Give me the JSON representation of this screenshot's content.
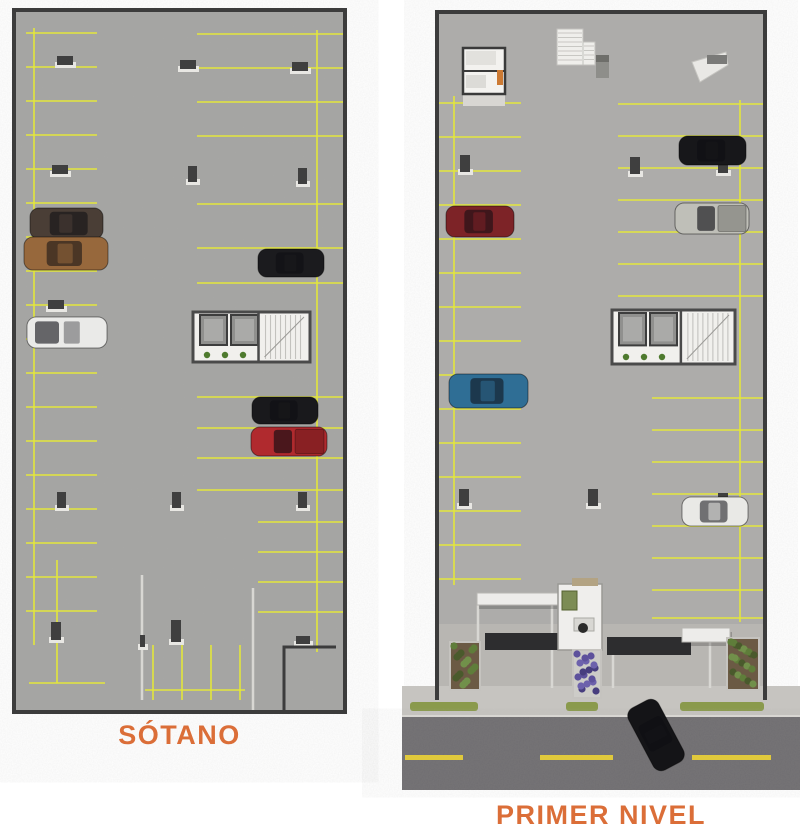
{
  "labels": {
    "sotano": "SÓTANO",
    "primer_nivel": "PRIMER NIVEL"
  },
  "colors": {
    "label_text": "#db6e38",
    "wall": "#3c3c3c",
    "floor_sotano": "#a5a5a3",
    "floor_primer": "#adacaa",
    "plaza": "#b9b7b3",
    "line_yellow": "#e3e63c",
    "line_light": "#d8d7d3",
    "column": "#3f3f3f",
    "column_base": "#e8e7e3",
    "core_floor": "#f1f0ed",
    "core_wall": "#4a4a4a",
    "elevator_cab": "#90908e",
    "plant_green": "#4e7a2e",
    "bush_green": "#5f7d3a",
    "bush_dark": "#4a5a2c",
    "soil_brown": "#6b5a44",
    "flower_purple": "#5d519c",
    "sidewalk": "#c6c4c0",
    "grass_strip": "#8a9a4c",
    "street": "#6f6d70",
    "street_mark": "#e0c93c",
    "drive_dark": "#2d2d2f",
    "canopy_white": "#edecea",
    "booth_wall": "#efeeec",
    "booth_window": "#7c8c54",
    "booth_desk": "#d8d7d3",
    "booth_chair": "#2a2a2a",
    "room_floor": "#f3f2ef",
    "accent_orange": "#cc7a33"
  },
  "plans": [
    {
      "id": "sotano",
      "label_key": "sotano",
      "floor": [
        14,
        10,
        331,
        702
      ],
      "wall": "rect",
      "yellow_vlines": [
        [
          34,
          28,
          645
        ],
        [
          57,
          560,
          683
        ],
        [
          317,
          30,
          652
        ],
        [
          153,
          645,
          700
        ],
        [
          182,
          645,
          700
        ],
        [
          211,
          645,
          700
        ],
        [
          240,
          645,
          700
        ]
      ],
      "yellow_hlines": [
        {
          "x1": 26,
          "x2": 97,
          "ys": [
            33,
            67,
            101,
            135,
            169,
            203,
            237,
            271,
            305,
            339,
            373,
            407,
            441,
            475,
            509,
            543,
            577,
            611
          ]
        },
        {
          "x1": 197,
          "x2": 343,
          "ys": [
            34,
            68,
            102,
            136,
            204,
            248,
            283
          ]
        },
        {
          "x1": 197,
          "x2": 343,
          "ys": [
            397,
            428,
            458,
            490
          ]
        },
        {
          "x1": 258,
          "x2": 343,
          "ys": [
            522,
            552,
            582,
            612
          ]
        },
        {
          "x1": 29,
          "x2": 105,
          "ys": [
            683
          ]
        },
        {
          "x1": 145,
          "x2": 245,
          "ys": [
            690
          ]
        }
      ],
      "light_vlines": [
        [
          142,
          575,
          700
        ],
        [
          253,
          588,
          710
        ]
      ],
      "columns": [
        [
          57,
          56,
          16,
          9
        ],
        [
          180,
          60,
          16,
          9
        ],
        [
          292,
          62,
          16,
          9
        ],
        [
          52,
          165,
          16,
          9
        ],
        [
          188,
          166,
          9,
          16
        ],
        [
          298,
          168,
          9,
          16
        ],
        [
          48,
          300,
          16,
          9
        ],
        [
          57,
          492,
          9,
          16
        ],
        [
          172,
          492,
          9,
          16
        ],
        [
          298,
          492,
          9,
          16
        ],
        [
          51,
          622,
          10,
          18
        ],
        [
          171,
          620,
          10,
          22
        ],
        [
          296,
          636,
          14,
          8
        ],
        [
          140,
          635,
          5,
          12
        ]
      ],
      "cores": [
        [
          193,
          312,
          117,
          50
        ]
      ],
      "wall_paths": [
        "M284,712 L284,647 L336,647"
      ],
      "cars": [
        {
          "name": "brown-suv",
          "x": 30,
          "y": 208,
          "w": 73,
          "h": 31,
          "color": "#4a3e36",
          "type": "suv"
        },
        {
          "name": "bronze-sedan",
          "x": 24,
          "y": 237,
          "w": 84,
          "h": 33,
          "color": "#97683c",
          "type": "sedan"
        },
        {
          "name": "white-van",
          "x": 27,
          "y": 317,
          "w": 80,
          "h": 31,
          "color": "#eaeae8",
          "type": "van"
        },
        {
          "name": "black-sedan-right",
          "x": 258,
          "y": 249,
          "w": 66,
          "h": 28,
          "color": "#1b1b1e",
          "type": "sedan"
        },
        {
          "name": "black-sedan-mid",
          "x": 252,
          "y": 397,
          "w": 66,
          "h": 27,
          "color": "#19191c",
          "type": "sedan"
        },
        {
          "name": "red-pickup",
          "x": 251,
          "y": 427,
          "w": 76,
          "h": 29,
          "color": "#b02a2e",
          "type": "pickup"
        }
      ]
    },
    {
      "id": "primer-nivel",
      "label_key": "primer_nivel",
      "floor": [
        437,
        12,
        328,
        676
      ],
      "wall": "u",
      "plaza": [
        439,
        624,
        324,
        64
      ],
      "sidewalk": [
        402,
        686,
        398,
        32
      ],
      "grass": [
        [
          410,
          702,
          68,
          9
        ],
        [
          566,
          702,
          32,
          9
        ],
        [
          680,
          702,
          84,
          9
        ]
      ],
      "street": [
        402,
        716,
        398,
        74
      ],
      "street_dashes": [
        [
          405,
          755,
          58,
          5
        ],
        [
          540,
          755,
          73,
          5
        ],
        [
          692,
          755,
          79,
          5
        ]
      ],
      "yellow_vlines": [
        [
          454,
          96,
          585
        ],
        [
          740,
          100,
          622
        ]
      ],
      "yellow_hlines": [
        {
          "x1": 439,
          "x2": 521,
          "ys": [
            103,
            137,
            171,
            205,
            239,
            273,
            307,
            341,
            375,
            409,
            443,
            477,
            511,
            545,
            579
          ]
        },
        {
          "x1": 618,
          "x2": 763,
          "ys": [
            104,
            136,
            168,
            200,
            232,
            264,
            296
          ]
        },
        {
          "x1": 652,
          "x2": 763,
          "ys": [
            398,
            430,
            462,
            494,
            526,
            558,
            590,
            618
          ]
        }
      ],
      "light_vlines": [
        [
          478,
          605,
          688
        ],
        [
          552,
          605,
          688
        ],
        [
          613,
          637,
          688
        ],
        [
          710,
          642,
          688
        ]
      ],
      "columns": [
        [
          460,
          155,
          10,
          17
        ],
        [
          630,
          157,
          10,
          17
        ],
        [
          718,
          158,
          10,
          15
        ],
        [
          459,
          489,
          10,
          17
        ],
        [
          588,
          489,
          10,
          17
        ],
        [
          718,
          493,
          10,
          15
        ]
      ],
      "cores": [
        [
          612,
          310,
          123,
          54
        ]
      ],
      "wall_paths": [],
      "room": {
        "x": 463,
        "y": 48,
        "w": 42,
        "h": 46,
        "divider_y": 71,
        "apron": [
          463,
          94,
          42,
          12
        ],
        "furn": [
          [
            466,
            51,
            30,
            14,
            "#e2e1dd"
          ],
          [
            466,
            75,
            20,
            13,
            "#dcdbd7"
          ],
          [
            497,
            70,
            6,
            15,
            "#cc7a33"
          ]
        ]
      },
      "stairs": [
        [
          557,
          29,
          26,
          36
        ],
        [
          583,
          42,
          12,
          23
        ]
      ],
      "boxes": [
        [
          596,
          55,
          13,
          23
        ]
      ],
      "ramp": {
        "x": 692,
        "y": 52,
        "w": 36,
        "h": 30
      },
      "canopies": [
        [
          477,
          593,
          84,
          12
        ],
        [
          682,
          628,
          48,
          14
        ]
      ],
      "drives": [
        [
          485,
          633,
          75,
          17
        ],
        [
          607,
          637,
          84,
          18
        ]
      ],
      "booth": {
        "x": 558,
        "y": 584,
        "w": 44,
        "h": 66
      },
      "planters": [
        {
          "x": 450,
          "y": 642,
          "w": 30,
          "h": 48,
          "kind": "green"
        },
        {
          "x": 727,
          "y": 638,
          "w": 32,
          "h": 52,
          "kind": "green"
        },
        {
          "x": 573,
          "y": 650,
          "w": 28,
          "h": 48,
          "kind": "purple"
        }
      ],
      "cars": [
        {
          "name": "darkred-sedan",
          "x": 446,
          "y": 206,
          "w": 68,
          "h": 31,
          "color": "#7d2327",
          "type": "sedan"
        },
        {
          "name": "blue-sedan",
          "x": 449,
          "y": 374,
          "w": 79,
          "h": 34,
          "color": "#2f6e95",
          "type": "sedan"
        },
        {
          "name": "black-sedan-top",
          "x": 679,
          "y": 136,
          "w": 67,
          "h": 29,
          "color": "#17171a",
          "type": "sedan"
        },
        {
          "name": "silver-pickup",
          "x": 675,
          "y": 203,
          "w": 74,
          "h": 31,
          "color": "#bfbfb8",
          "type": "pickup"
        },
        {
          "name": "white-sedan",
          "x": 682,
          "y": 497,
          "w": 66,
          "h": 29,
          "color": "#e9e9e6",
          "type": "sedan"
        },
        {
          "name": "street-black-car",
          "x": 621,
          "y": 718,
          "w": 70,
          "h": 34,
          "color": "#141417",
          "type": "sedan",
          "angle": 62
        }
      ]
    }
  ]
}
